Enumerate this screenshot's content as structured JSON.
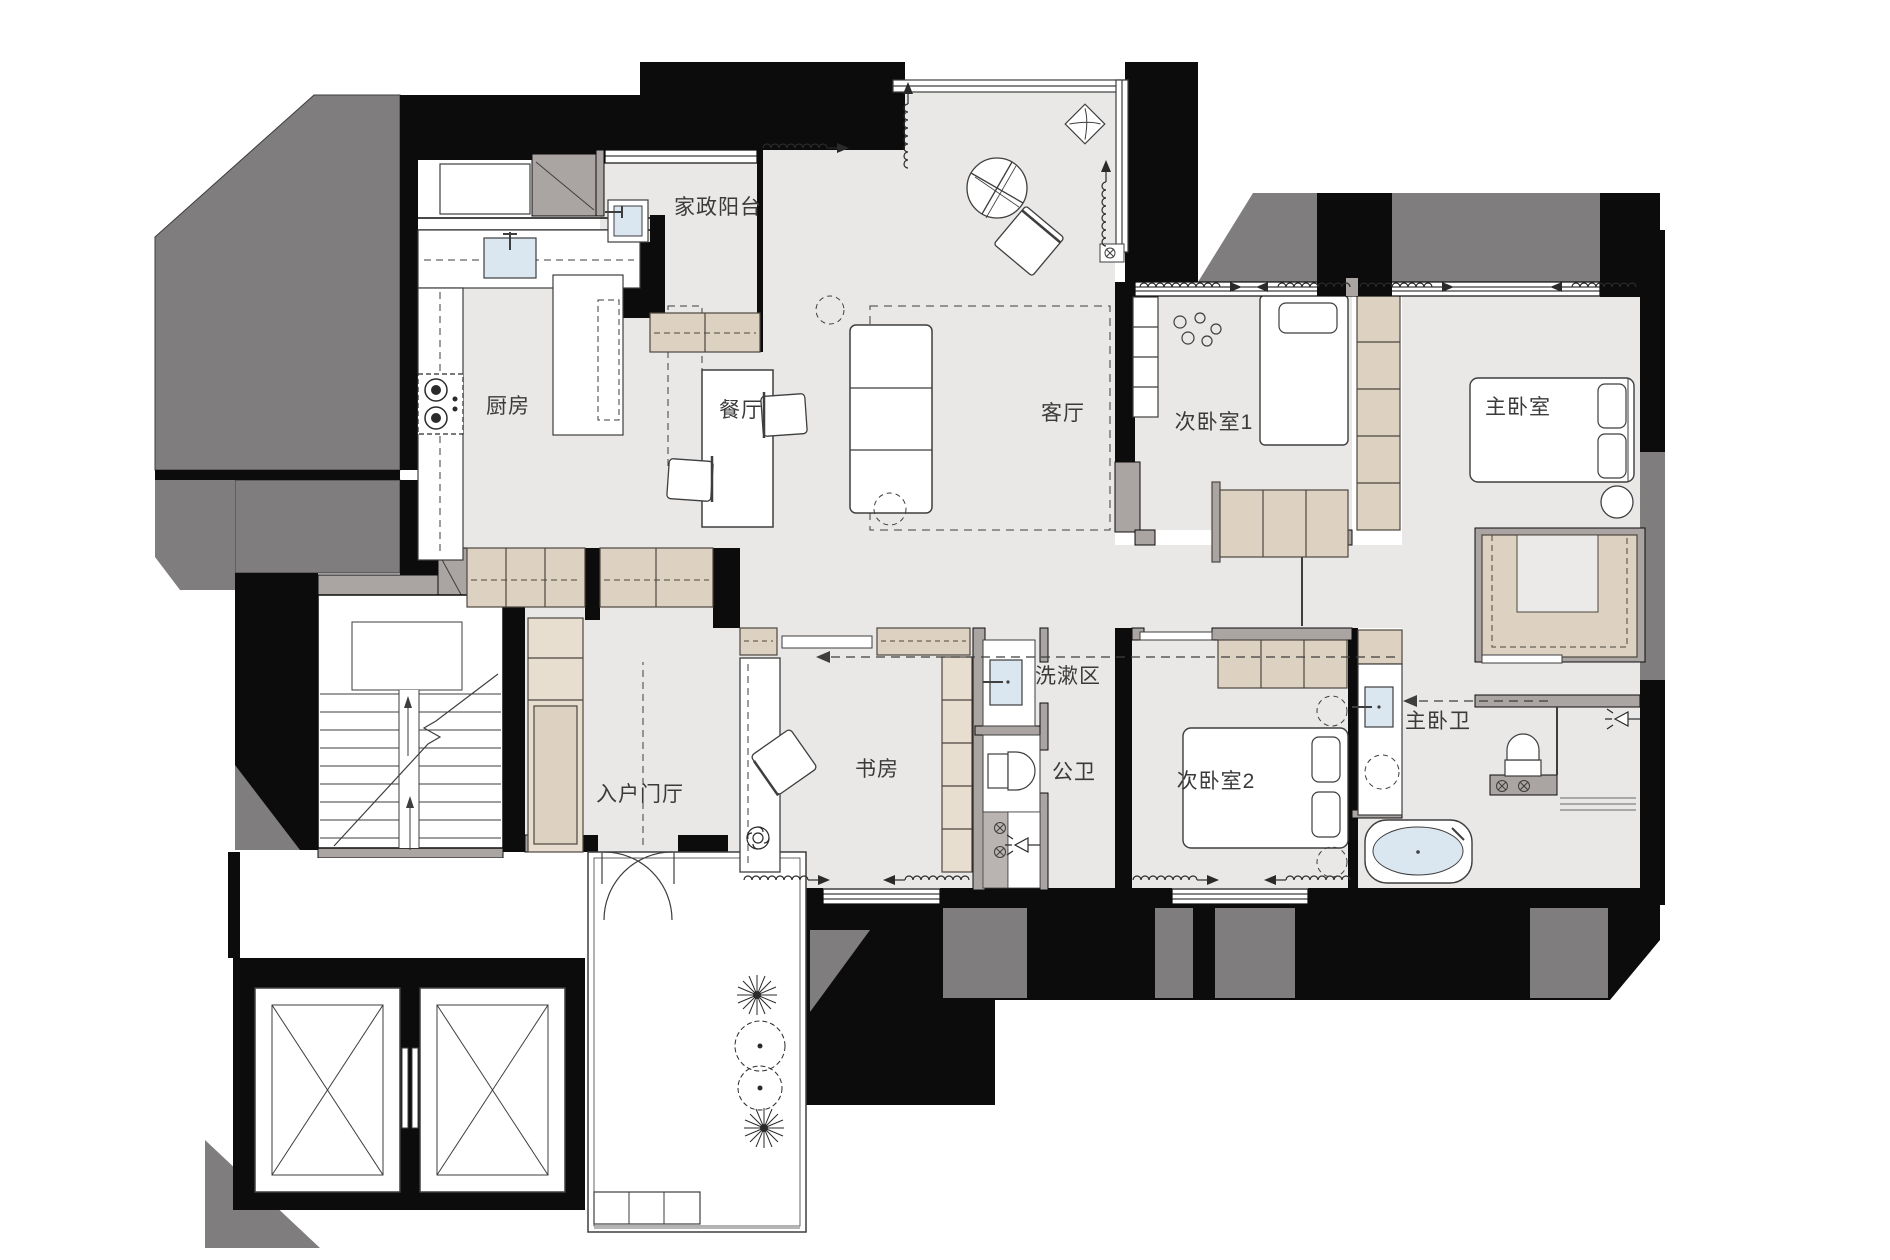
{
  "plan": {
    "type": "apartment-floor-plan",
    "language": "zh-CN",
    "rooms": [
      {
        "id": "laundry-balcony",
        "label": "家政阳台",
        "x": 718,
        "y": 214
      },
      {
        "id": "kitchen",
        "label": "厨房",
        "x": 508,
        "y": 413
      },
      {
        "id": "dining",
        "label": "餐厅",
        "x": 741,
        "y": 417
      },
      {
        "id": "living",
        "label": "客厅",
        "x": 1063,
        "y": 420
      },
      {
        "id": "bedroom-1",
        "label": "次卧室1",
        "x": 1214,
        "y": 429
      },
      {
        "id": "master-bedroom",
        "label": "主卧室",
        "x": 1518,
        "y": 414
      },
      {
        "id": "foyer",
        "label": "入户门厅",
        "x": 640,
        "y": 801
      },
      {
        "id": "study",
        "label": "书房",
        "x": 877,
        "y": 776
      },
      {
        "id": "wash-area",
        "label": "洗漱区",
        "x": 1068,
        "y": 683
      },
      {
        "id": "public-bath",
        "label": "公卫",
        "x": 1074,
        "y": 779
      },
      {
        "id": "bedroom-2",
        "label": "次卧室2",
        "x": 1216,
        "y": 788
      },
      {
        "id": "master-bath",
        "label": "主卧卫",
        "x": 1438,
        "y": 728
      }
    ],
    "colors": {
      "floor": "#e9e8e7",
      "wall_black": "#0c0c0c",
      "structure_gray": "#7f7d7d",
      "partition_gray": "#aaa5a2",
      "cabinet_tan": "#ddd2c1",
      "cabinet_tan_light": "#e7decf",
      "fixture_blue": "#dbe7f0",
      "line": "#3e3e3e",
      "text": "#3a3a3a"
    },
    "icons": {
      "curtain-symbol": "coil-wave-with-arrow",
      "door-swing-icon": "quarter-arc",
      "shower-head-icon": "triangle-with-spray-lines",
      "ceiling-fan-icon": "circle-with-blades",
      "drain-icon": "circle-with-x",
      "plant-icon": "spiky-circle",
      "tree-icon": "dashed-circle-with-dot",
      "elevator-icon": "box-with-x-cross",
      "stairs-icon": "treads-with-break-line"
    }
  }
}
